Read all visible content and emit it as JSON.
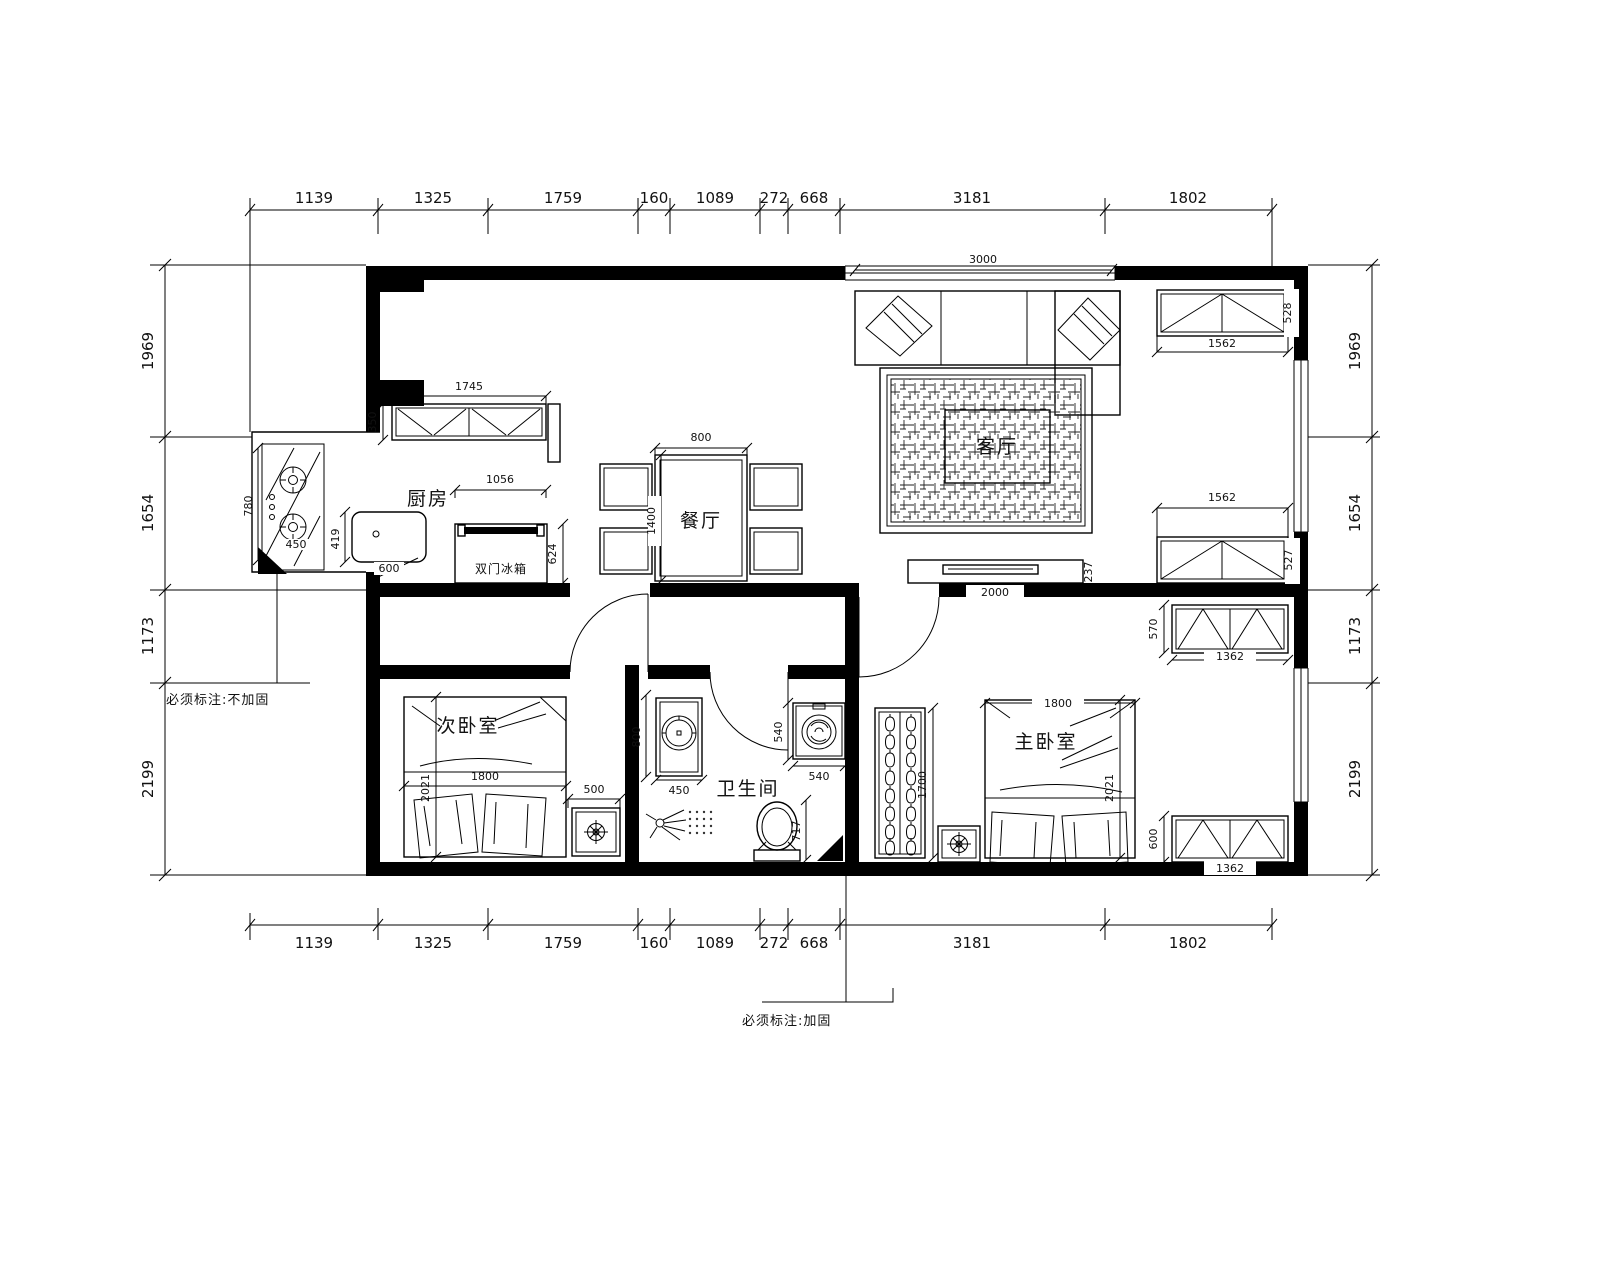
{
  "plan": {
    "annotations": {
      "left": "必须标注:不加固",
      "bottom": "必须标注:加固"
    },
    "rooms": {
      "kitchen": "厨房",
      "dining": "餐厅",
      "living": "客厅",
      "second_bedroom": "次卧室",
      "master_bedroom": "主卧室",
      "bathroom": "卫生间"
    },
    "appliances": {
      "fridge": "双门冰箱"
    },
    "dims": {
      "top": [
        "1139",
        "1325",
        "1759",
        "160",
        "1089",
        "272",
        "668",
        "3181",
        "1802"
      ],
      "bottom": [
        "1139",
        "1325",
        "1759",
        "160",
        "1089",
        "272",
        "668",
        "3181",
        "1802"
      ],
      "left": [
        "1969",
        "1654",
        "1173",
        "2199"
      ],
      "right": [
        "1969",
        "1654",
        "1173",
        "2199"
      ],
      "interior": {
        "living_width": "3000",
        "kitchen_cabinet_width": "1745",
        "kitchen_cabinet_depth": "350",
        "fridge_width": "1056",
        "fridge_depth": "624",
        "counter_length": "780",
        "cooktop": "450",
        "sink_depth": "419",
        "sink_width": "600",
        "table_width": "800",
        "table_length": "1400",
        "tv_width": "2000",
        "tv_depth": "237",
        "cabinet_top_width": "1562",
        "cabinet_top_depth": "528",
        "cabinet_mid_width": "1562",
        "cabinet_mid_depth": "527",
        "wardrobe_top_width": "1362",
        "wardrobe_top_depth": "570",
        "wardrobe_bottom_width": "1362",
        "wardrobe_bottom_depth": "600",
        "bed2_width": "1800",
        "bed2_length": "2021",
        "nightstand2": "500",
        "bath_niche": "800",
        "basin_width": "450",
        "washer_depth": "540",
        "washer_width": "540",
        "toilet_depth": "717",
        "closet_length": "1700",
        "bed1_width": "1800",
        "bed1_length": "2021"
      }
    }
  }
}
